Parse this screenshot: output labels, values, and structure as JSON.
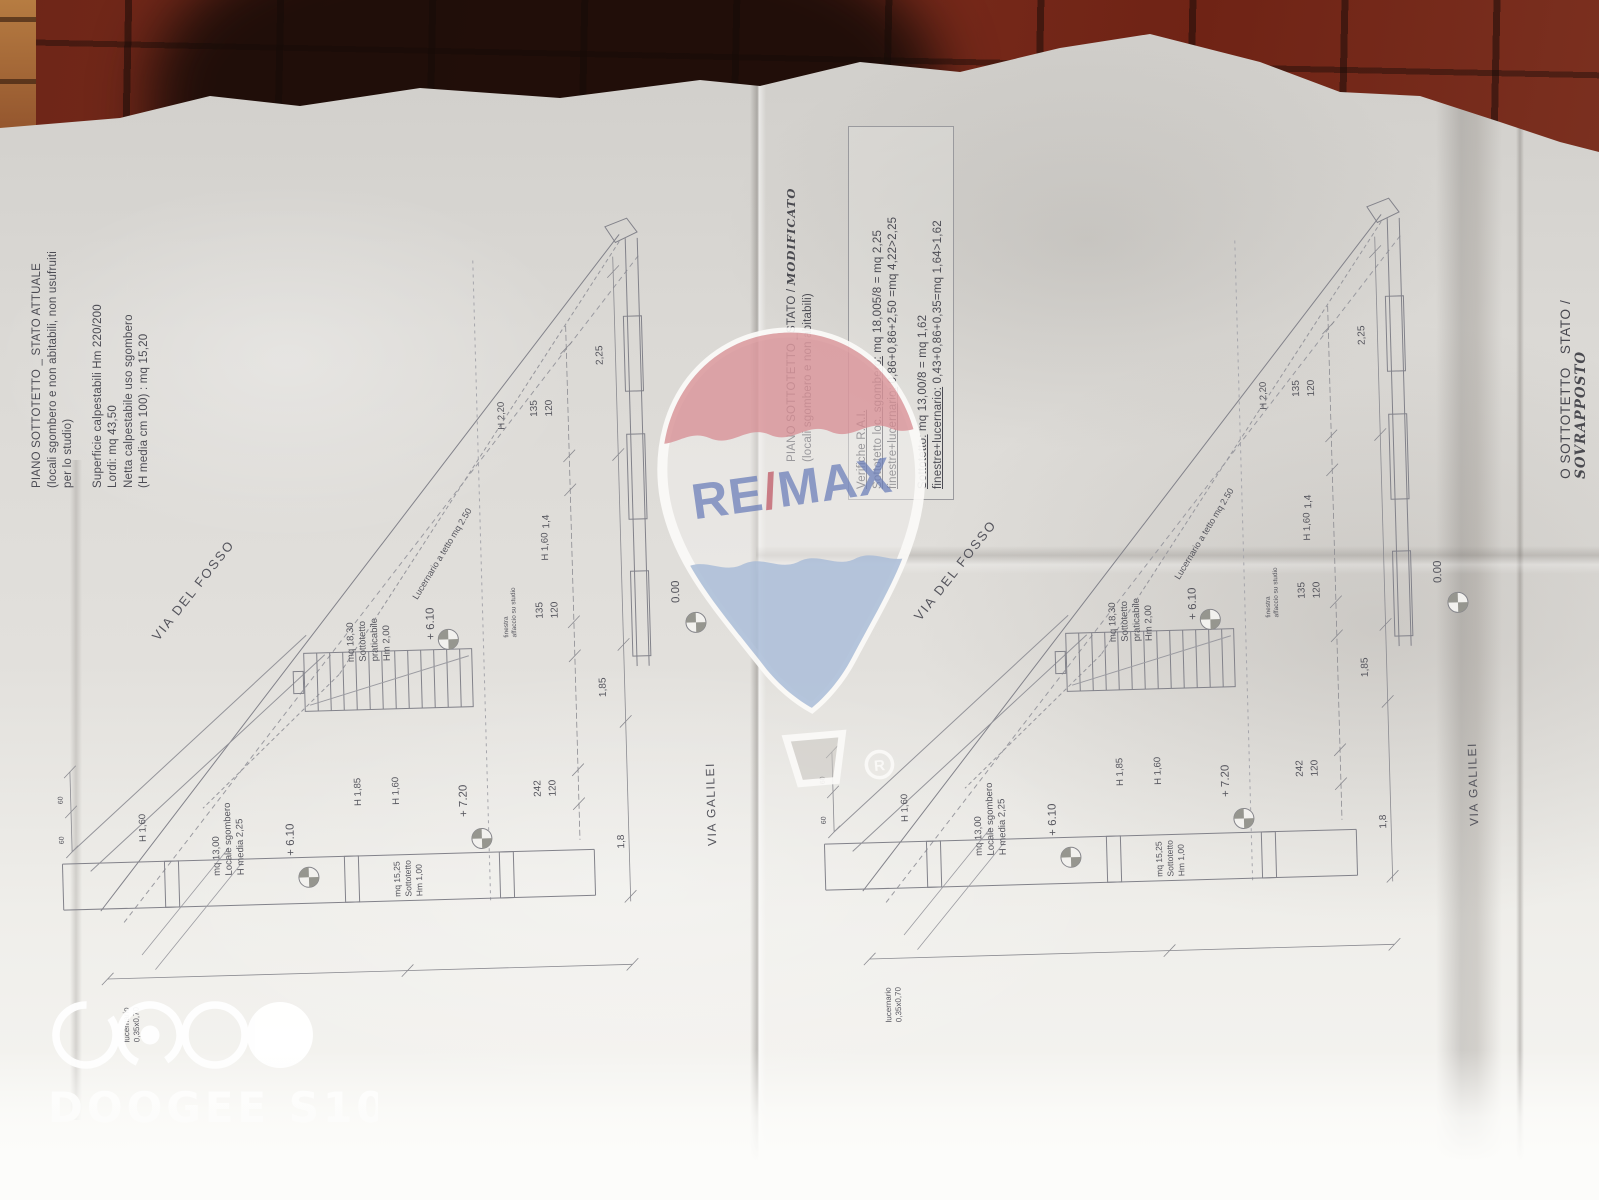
{
  "left_title_block": {
    "line1": "PIANO SOTTOTETTO _ STATO ATTUALE",
    "line2": "(locali sgombero e non abitabili, non usufruiti",
    "line3": "per lo studio)",
    "line4": "Superficie calpestabili Hm 220/200",
    "line5": "Lordi: mq 43,50",
    "line6": "Netta calpestabile uso sgombero",
    "line7": "(H media cm 100) : mq 15,20"
  },
  "right_title_block": {
    "line1": "PIANO SOTTOTETTO _STATO /",
    "handwritten": "MODIFICATO",
    "line2": "(locali sgombero e non abitabili)"
  },
  "verifiche": {
    "title": "Verifiche R.A.I.",
    "r1_label": "Sottotetto loc. sgombero:",
    "r1_value": " mq 18,005/8 = mq 2,25",
    "r2_label": "finestre+lucernario:",
    "r2_value": " 0,86+0,86+2,50 =mq 4,22>2,25",
    "r3_label": "Sottotetto:",
    "r3_value": " mq 13,00/8 = mq 1,62",
    "r4_label": "finestre+lucernario:",
    "r4_value": " 0,43+0,86+0,35=mq 1,64>1,62"
  },
  "edge_title": {
    "printed": "O SOTTOTETTO   STATO /",
    "handwritten": "SOVRAPPOSTO"
  },
  "plan": {
    "via_del_fosso": "VIA DEL FOSSO",
    "via_galilei": "VIA GALILEI",
    "lucernario_roof": "Lucernario a tetto mq 2.50",
    "room_sottotetto": [
      "mq 18,30",
      "Sottotetto",
      "praticabile",
      "Hm 2,00"
    ],
    "room_locale": [
      "mq 13,00",
      "Locale sgombero",
      "H media 2,25"
    ],
    "room_sottotetto2": [
      "mq 15,25",
      "Sottotetto",
      "Hm 1,00"
    ],
    "skylight": [
      "lucernario",
      "0,35x0,70"
    ],
    "window_note": [
      "finestra",
      "affaccio su studio"
    ],
    "levels": {
      "plus610": "+ 6.10",
      "plus720": "+ 7.20",
      "zero": "0.00"
    },
    "heights": {
      "h220": "H 2,20",
      "h160": "H 1,60",
      "h185": "H 1,85"
    },
    "dims": {
      "w225": "2,25",
      "w14": "1,4",
      "w185": "1,85",
      "w18": "1,8",
      "s135": "135",
      "s120": "120",
      "s242": "242",
      "t60": "60"
    }
  },
  "watermarks": {
    "remax_re": "RE",
    "remax_slash": "/",
    "remax_max": "MAX",
    "registered": "R",
    "camera": "DOOGEE S100"
  }
}
